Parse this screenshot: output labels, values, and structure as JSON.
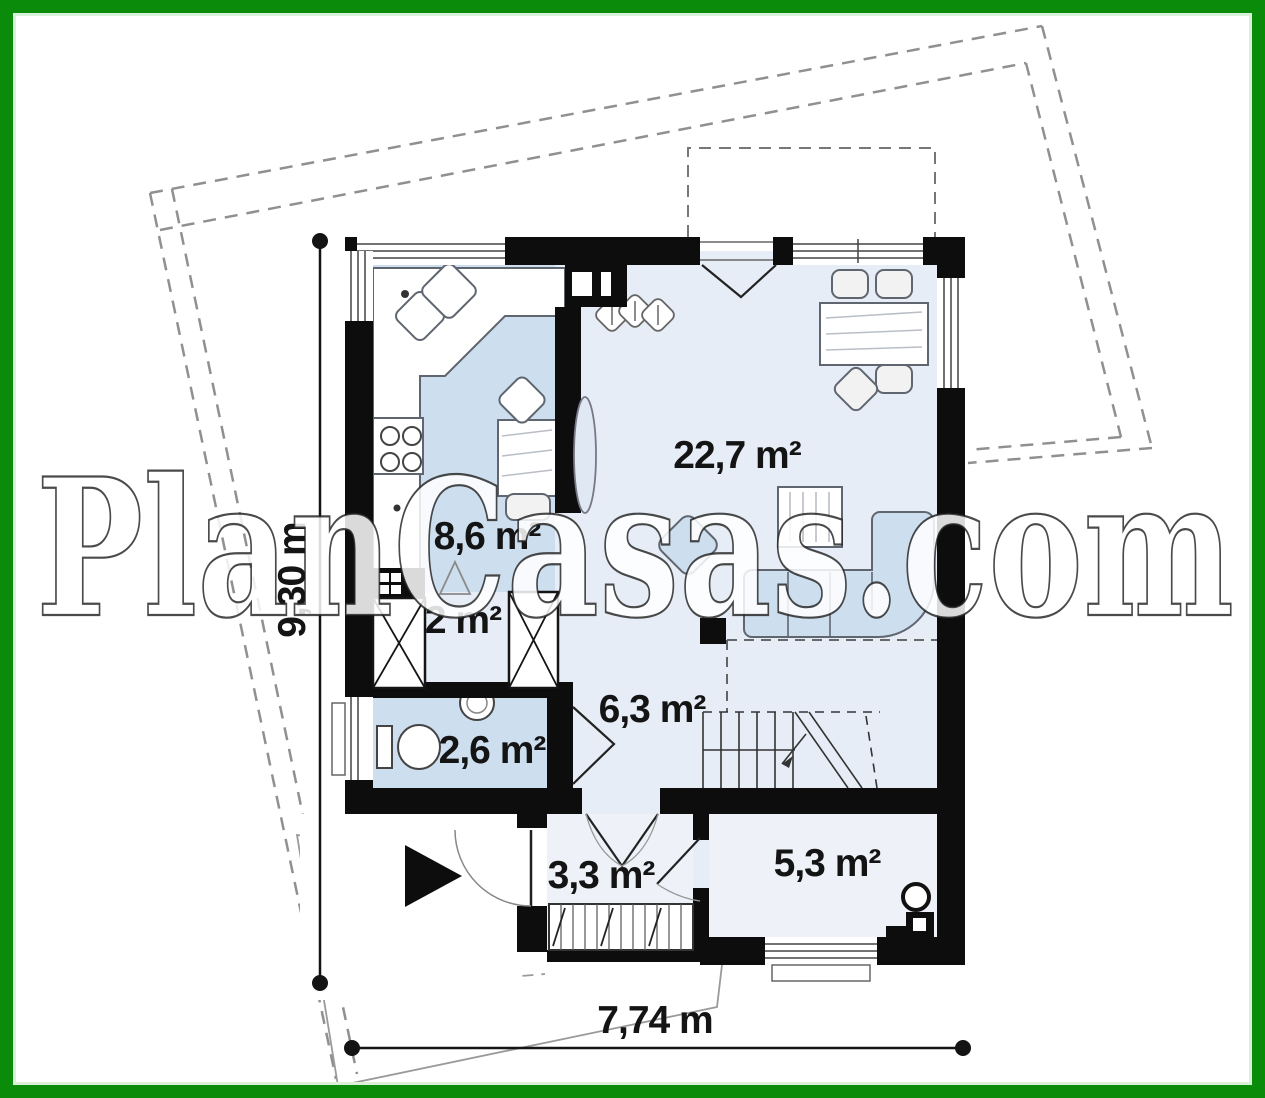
{
  "watermark": "PlanCasas.com",
  "plan": {
    "rooms": [
      {
        "name": "kitchen",
        "area_label": "8,6 m²"
      },
      {
        "name": "living-dining",
        "area_label": "22,7 m²"
      },
      {
        "name": "wardrobe",
        "area_label": "2 m²"
      },
      {
        "name": "bathroom",
        "area_label": "2,6 m²"
      },
      {
        "name": "hall",
        "area_label": "6,3 m²"
      },
      {
        "name": "vestibule",
        "area_label": "3,3 m²"
      },
      {
        "name": "utility",
        "area_label": "5,3 m²"
      }
    ],
    "dimensions": {
      "width_label": "7,74 m",
      "height_label": "9,30 m"
    }
  },
  "colors": {
    "frame_green": "#0a8b0a",
    "wall_black": "#0d0d0d",
    "floor_blue": "#cddeee",
    "floor_light": "#e7edf6",
    "boundary_gray": "#909090"
  }
}
